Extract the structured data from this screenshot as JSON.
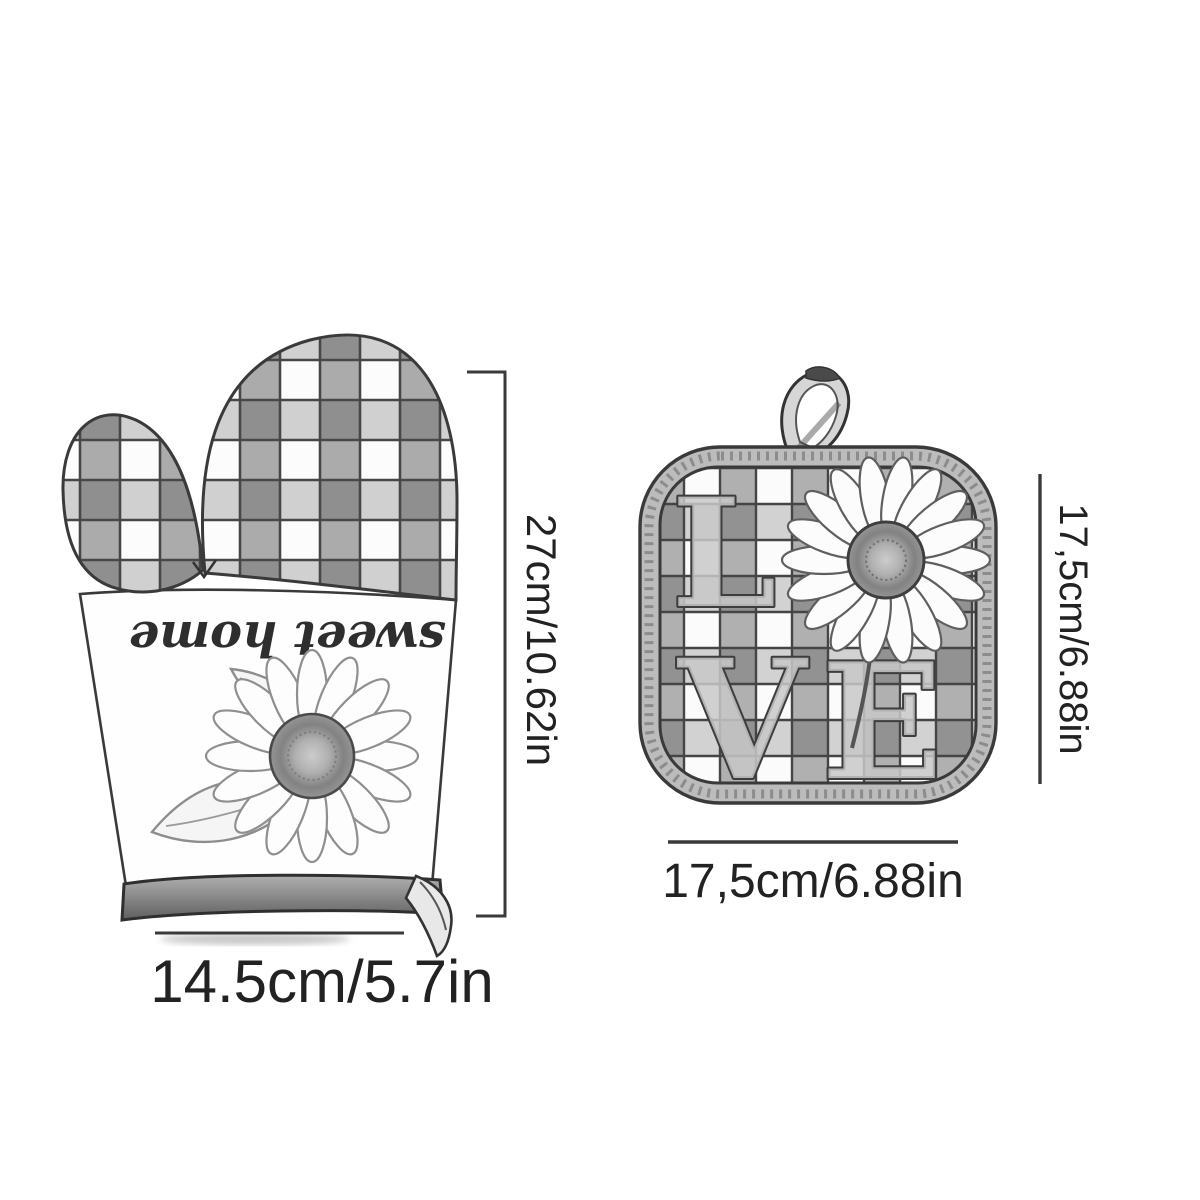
{
  "canvas": {
    "background": "#ffffff"
  },
  "palette": {
    "ink": "#3a3a3a",
    "label_text": "#222222",
    "check_gray": "#ababab",
    "check_dark": "#8f8f8f",
    "binding_gray": "#bcbcbc",
    "cuff_dark": "#6e6e6e"
  },
  "oven_mitt": {
    "print_text": "sweet home",
    "height_label": "27cm/10.62in",
    "width_label": "14.5cm/5.7in",
    "motifs": {
      "pattern_icon": "gingham-check-pattern",
      "flower_icon": "sunflower-icon",
      "loop_icon": "hanging-loop-icon"
    }
  },
  "pot_holder": {
    "word": "LOVE",
    "letters": [
      "L",
      "V",
      "E"
    ],
    "o_replacement_icon": "sunflower-icon",
    "height_label": "17,5cm/6.88in",
    "width_label": "17,5cm/6.88in",
    "motifs": {
      "pattern_icon": "gingham-check-pattern",
      "loop_icon": "hanging-loop-icon"
    }
  }
}
